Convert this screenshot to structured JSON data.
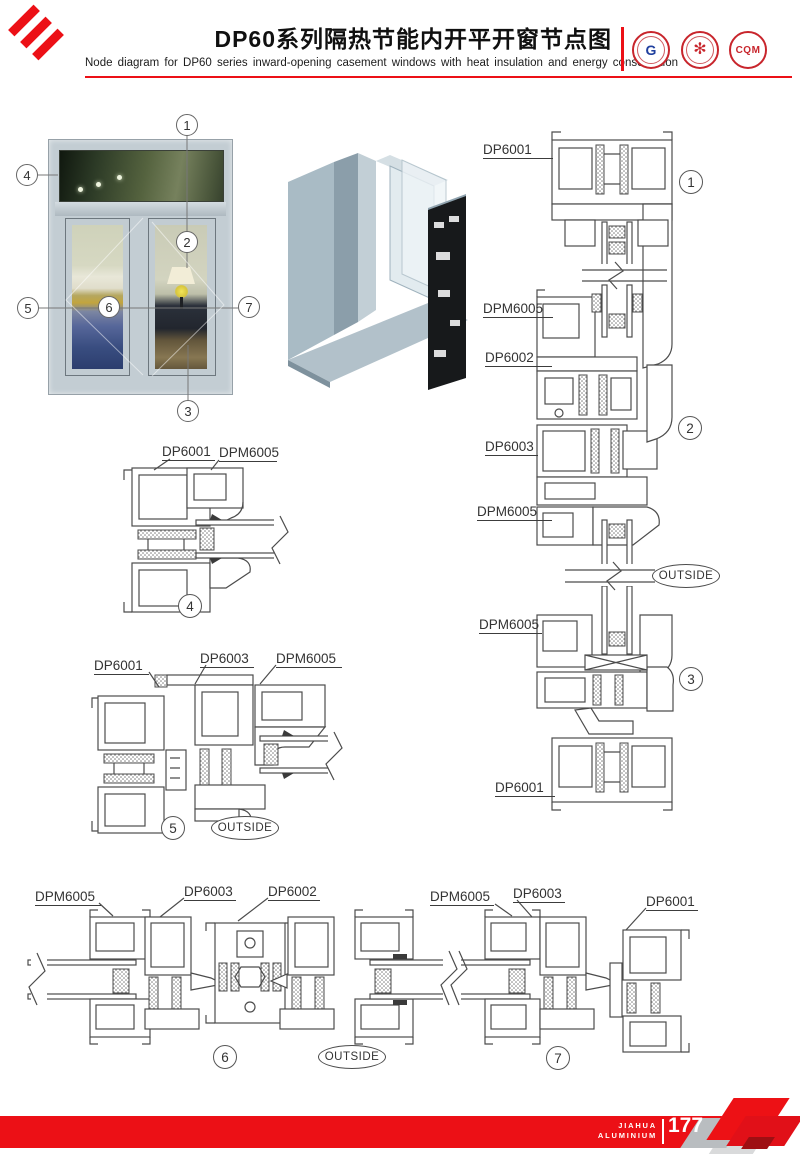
{
  "header": {
    "title": "DP60系列隔热节能内开平开窗节点图",
    "subtitle": "Node diagram for DP60 series inward-opening casement windows with heat insulation and energy conservation",
    "accent_color": "#ec1016",
    "logos": [
      {
        "name": "gtb-seal",
        "abbr": "G"
      },
      {
        "name": "star-seal",
        "abbr": "✻"
      },
      {
        "name": "cqm-seal",
        "abbr": "CQM"
      }
    ]
  },
  "photo": {
    "callouts": [
      "1",
      "2",
      "3",
      "4",
      "5",
      "6",
      "7"
    ]
  },
  "sections": {
    "vertical": {
      "labels": [
        "DP6001",
        "DPM6005",
        "DP6002",
        "DP6003",
        "DPM6005",
        "DPM6005",
        "DP6001"
      ],
      "nodes": [
        "1",
        "2",
        "3"
      ],
      "outside": "OUTSIDE"
    },
    "detail4": {
      "labels": [
        "DP6001",
        "DPM6005"
      ],
      "node": "4"
    },
    "detail5": {
      "labels": [
        "DP6001",
        "DP6003",
        "DPM6005"
      ],
      "node": "5",
      "outside": "OUTSIDE"
    },
    "horizontal": {
      "left": {
        "labels": [
          "DPM6005",
          "DP6003",
          "DP6002"
        ],
        "node": "6",
        "outside": "OUTSIDE"
      },
      "right": {
        "labels": [
          "DPM6005",
          "DP6003",
          "DP6001"
        ],
        "node": "7"
      }
    }
  },
  "footer": {
    "brand_top": "JIAHUA",
    "brand_bottom": "ALUMINIUM",
    "page_number": "177"
  }
}
